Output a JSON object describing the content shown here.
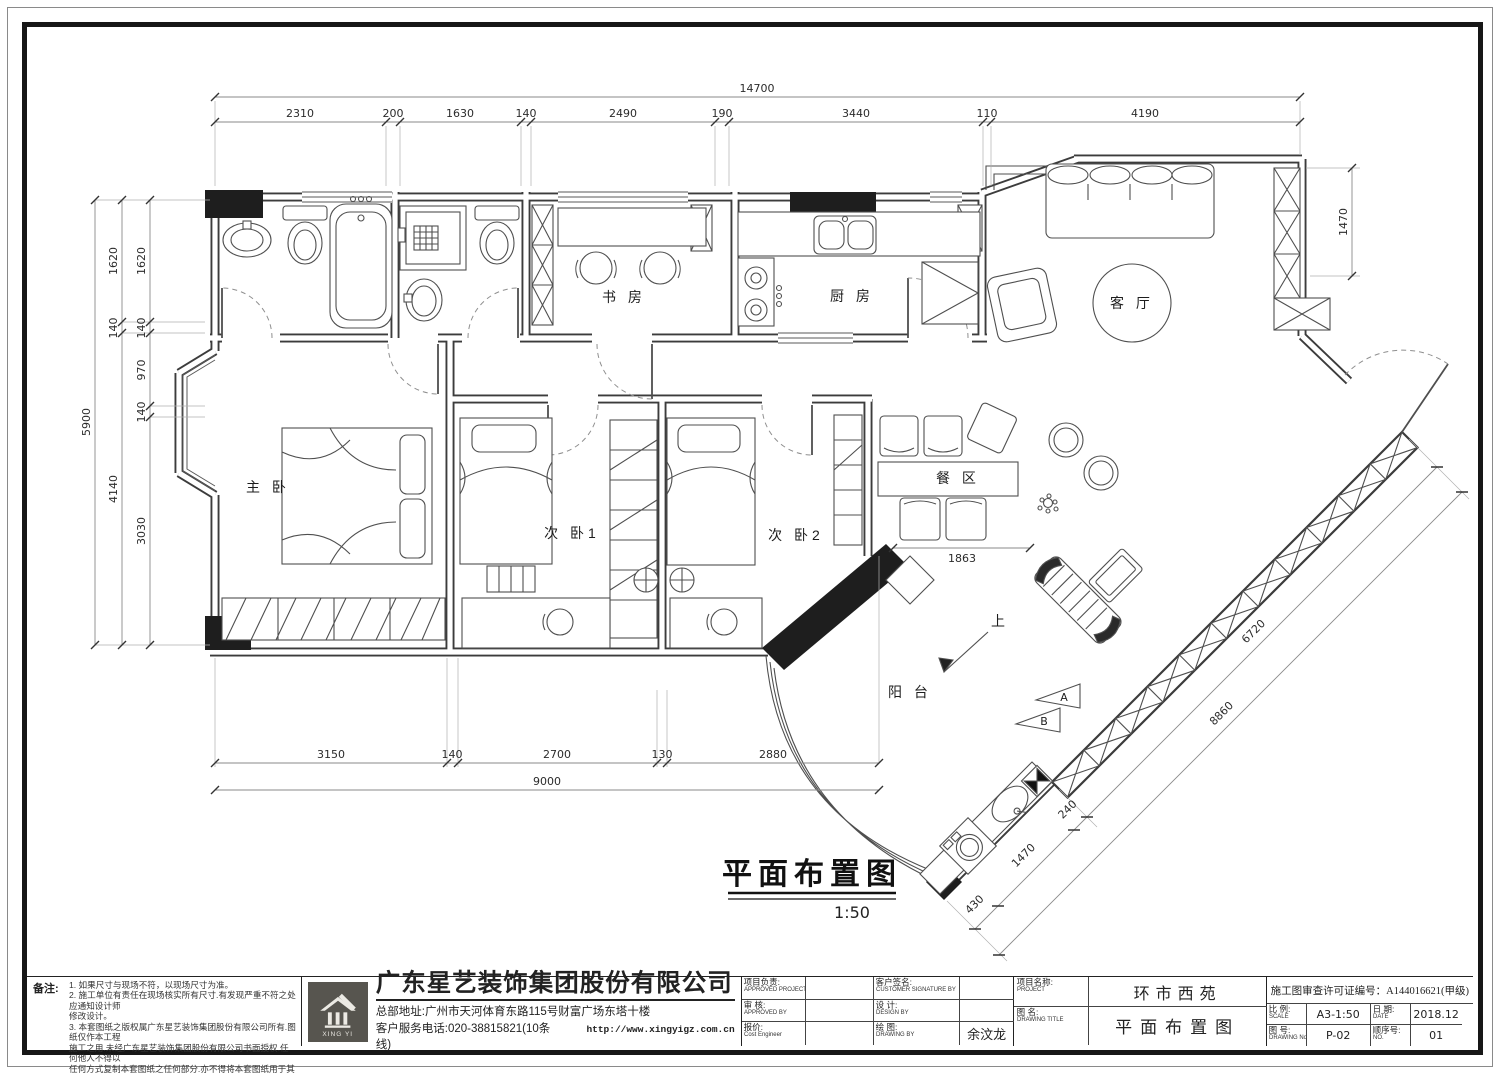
{
  "page": {
    "paper_color": "#ffffff",
    "line_color": "#3c3c3c",
    "accent_black": "#1e1e1e"
  },
  "plan": {
    "title": "平面布置图",
    "scale_note": "1:50",
    "rooms": {
      "master": "主 卧",
      "bed2": "次 卧1",
      "bed3": "次 卧2",
      "study": "书 房",
      "kitchen": "厨 房",
      "living": "客 厅",
      "dining": "餐 区",
      "balcony": "阳 台",
      "up": "上"
    },
    "markers": {
      "a": "A",
      "b": "B"
    },
    "dims": {
      "top_total": "14700",
      "top": [
        "2310",
        "200",
        "1630",
        "140",
        "2490",
        "190",
        "3440",
        "110",
        "4190"
      ],
      "left_total": "5900",
      "left_mid": [
        "1620",
        "140",
        "4140"
      ],
      "left_inner": [
        "1620",
        "140",
        "970",
        "140",
        "3030"
      ],
      "bottom": [
        "3150",
        "140",
        "2700",
        "130",
        "2880"
      ],
      "bottom_total": "9000",
      "right": "1470",
      "diag_inner": "6720",
      "diag_outer": "8860",
      "balcony": [
        "240",
        "1470",
        "430"
      ],
      "dining": "1863"
    }
  },
  "titleblock": {
    "notes": {
      "label": "备注:",
      "lines": [
        "1. 如果尺寸与现场不符，以现场尺寸为准。",
        "2. 施工单位有责任在现场核实所有尺寸.有发现严重不符之处应通知设计师",
        "    修改设计。",
        "3. 本套图纸之版权属广东星艺装饰集团股份有限公司所有.图纸仅作本工程",
        "    施工之用.未经广东星艺装饰集团股份有限公司书面授权.任何他人不得以",
        "    任何方式复制本套图纸之任何部分.亦不得将本套图纸用于其他任何用途。"
      ]
    },
    "company": {
      "name": "广东星艺装饰集团股份有限公司",
      "address": "总部地址:广州市天河体育东路115号财富广场东塔十楼",
      "phone": "客户服务电话:020-38815821(10条线)",
      "website": "http://www.xingyigz.com.cn",
      "logo_text": "XING YI"
    },
    "fields": {
      "approved_project": {
        "zh": "项目负责:",
        "en": "APPROVED PROJECT BY"
      },
      "customer_sign": {
        "zh": "客户签名:",
        "en": "CUSTOMER SIGNATURE BY"
      },
      "review": {
        "zh": "审 核:",
        "en": "APPROVED BY"
      },
      "design": {
        "zh": "设 计:",
        "en": "DESIGN BY"
      },
      "cost": {
        "zh": "报价:",
        "en": "Cost Engineer"
      },
      "draw": {
        "zh": "绘 图:",
        "en": "DRAWING BY",
        "value": "余汶龙"
      },
      "project": {
        "zh": "项目名称:",
        "en": "PROJECT",
        "value": "环市西苑"
      },
      "license": {
        "label": "施工图审查许可证编号：",
        "value": "A144016621(甲级)"
      },
      "title": {
        "zh": "图 名:",
        "en": "DRAWING TITLE",
        "value": "平面布置图"
      },
      "scale": {
        "zh": "比 例:",
        "en": "SCALE",
        "value": "A3-1:50"
      },
      "date": {
        "zh": "日 期:",
        "en": "DATE",
        "value": "2018.12"
      },
      "no": {
        "zh": "图 号:",
        "en": "DRAWING No",
        "value": "P-02"
      },
      "seq": {
        "zh": "顺序号:",
        "en": "NO.",
        "value": "01"
      }
    }
  }
}
